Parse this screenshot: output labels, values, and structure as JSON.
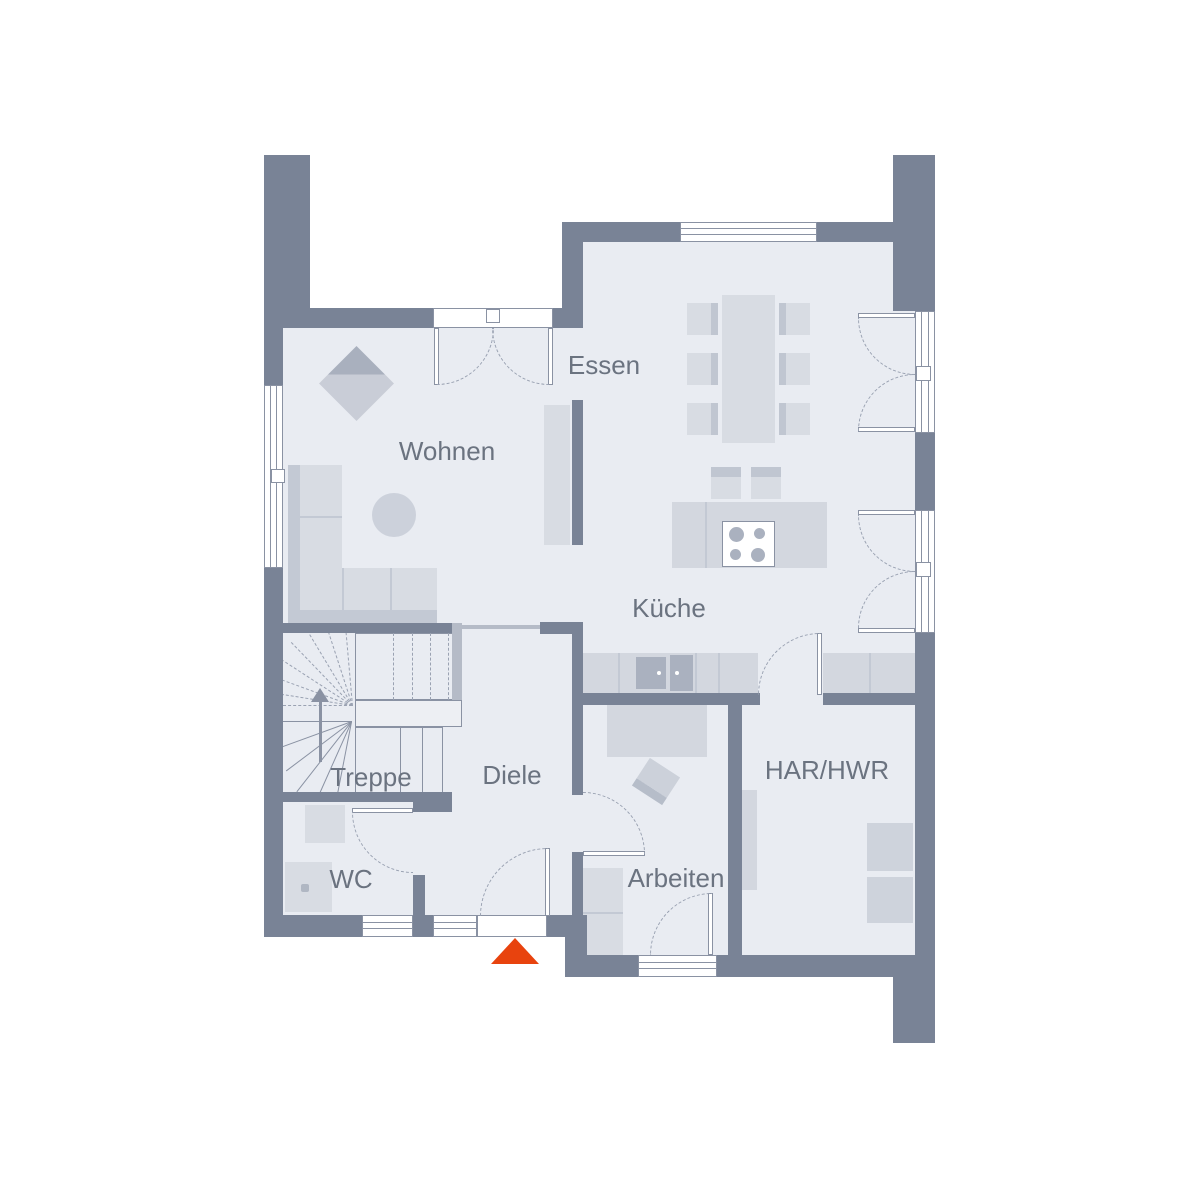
{
  "plan": {
    "type": "floor-plan",
    "rooms": {
      "essen": {
        "label": "Essen"
      },
      "wohnen": {
        "label": "Wohnen"
      },
      "kueche": {
        "label": "Küche"
      },
      "treppe": {
        "label": "Treppe"
      },
      "diele": {
        "label": "Diele"
      },
      "wc": {
        "label": "WC"
      },
      "arbeiten": {
        "label": "Arbeiten"
      },
      "har_hwr": {
        "label": "HAR/HWR"
      }
    },
    "entrance_marker": {
      "shape": "triangle-up",
      "color": "#e8430e"
    },
    "palette": {
      "wall": "#798396",
      "wall_light": "#b5bbc7",
      "floor": "#e9ecf2",
      "floor_bright": "#edeff3",
      "furniture": "#d3d7df",
      "furniture_light": "#d8dce3",
      "furniture_mid": "#c3c9d4",
      "furniture_dark": "#aab1bf",
      "line": "#8a92a3",
      "dash": "#9aa2b2",
      "label": "#6b7380",
      "window": "#ffffff",
      "accent": "#e8430e"
    }
  }
}
